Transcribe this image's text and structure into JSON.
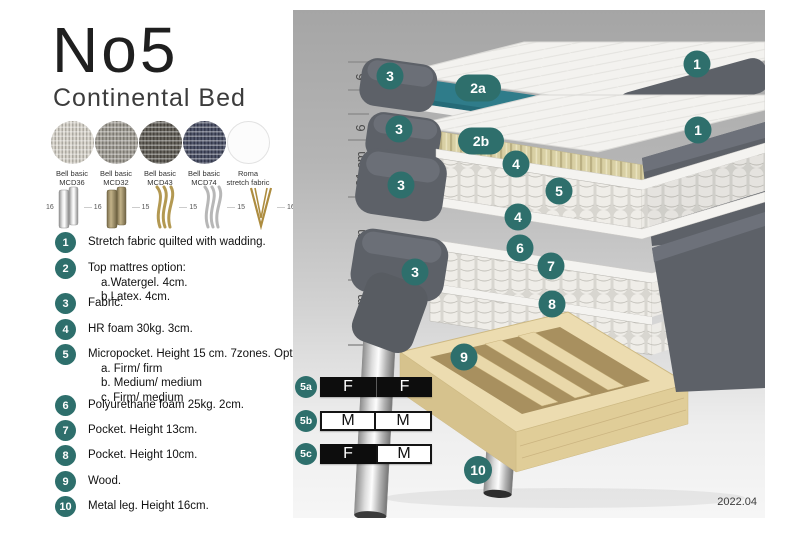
{
  "title": "No5",
  "subtitle": "Continental Bed",
  "fabrics": [
    {
      "line1": "Bell basic",
      "line2": "MCD36",
      "color": "#d6d2c8"
    },
    {
      "line1": "Bell basic",
      "line2": "MCD32",
      "color": "#9b978e"
    },
    {
      "line1": "Bell basic",
      "line2": "MCD43",
      "color": "#57544c"
    },
    {
      "line1": "Bell basic",
      "line2": "MCD74",
      "color": "#40455c"
    },
    {
      "line1": "Roma",
      "line2": "stretch fabric",
      "color": "#fcfcfc"
    }
  ],
  "legs": [
    {
      "height": "16",
      "style": "cylinder-silver"
    },
    {
      "height": "16",
      "style": "cylinder-bronze"
    },
    {
      "height": "15",
      "style": "curved-gold"
    },
    {
      "height": "15",
      "style": "curved-silver"
    },
    {
      "height": "15",
      "style": "hairpin-gold"
    },
    {
      "height": "16",
      "style": "cylinder-black-gold"
    }
  ],
  "list_items": [
    {
      "num": "1",
      "text": "Stretch fabric quilted with wadding.",
      "sub": []
    },
    {
      "num": "2",
      "text": "Top mattres option:",
      "sub": [
        "a.Watergel. 4cm.",
        "b.Latex. 4cm."
      ]
    },
    {
      "num": "3",
      "text": "Fabric.",
      "sub": []
    },
    {
      "num": "4",
      "text": "HR foam 30kg. 3cm.",
      "sub": []
    },
    {
      "num": "5",
      "text": "Micropocket. Height 15 cm. 7zones. Option:",
      "sub": [
        "a. Firm/ firm",
        "b. Medium/ medium",
        "c. Firm/ medium"
      ]
    },
    {
      "num": "6",
      "text": "Polyurethane foam 25kg. 2cm.",
      "sub": []
    },
    {
      "num": "7",
      "text": "Pocket. Height 13cm.",
      "sub": []
    },
    {
      "num": "8",
      "text": "Pocket. Height 10cm.",
      "sub": []
    },
    {
      "num": "9",
      "text": "Wood.",
      "sub": []
    },
    {
      "num": "10",
      "text": "Metal leg. Height 16cm.",
      "sub": []
    }
  ],
  "diagram": {
    "dimensions": [
      "6",
      "6",
      "21 cm",
      "27 cm",
      "16 cm"
    ],
    "badges": [
      "3",
      "2a",
      "1",
      "3",
      "2b",
      "1",
      "4",
      "5",
      "3",
      "4",
      "6",
      "7",
      "3",
      "8",
      "9",
      "10"
    ],
    "firmness": [
      {
        "label": "5a",
        "cell1": "F",
        "cell2": "F",
        "cell1_style": "dark",
        "cell2_style": "dark"
      },
      {
        "label": "5b",
        "cell1": "M",
        "cell2": "M",
        "cell1_style": "light",
        "cell2_style": "light"
      },
      {
        "label": "5c",
        "cell1": "F",
        "cell2": "M",
        "cell1_style": "dark",
        "cell2_style": "light"
      }
    ],
    "version": "2022.04"
  },
  "colors": {
    "badge_teal": "#2e6f6c",
    "layer_teal": "#2f7c8a",
    "fabric_gray": "#5d6168",
    "latex_tan": "#d9d0a4",
    "wood": "#e8d7aa"
  }
}
